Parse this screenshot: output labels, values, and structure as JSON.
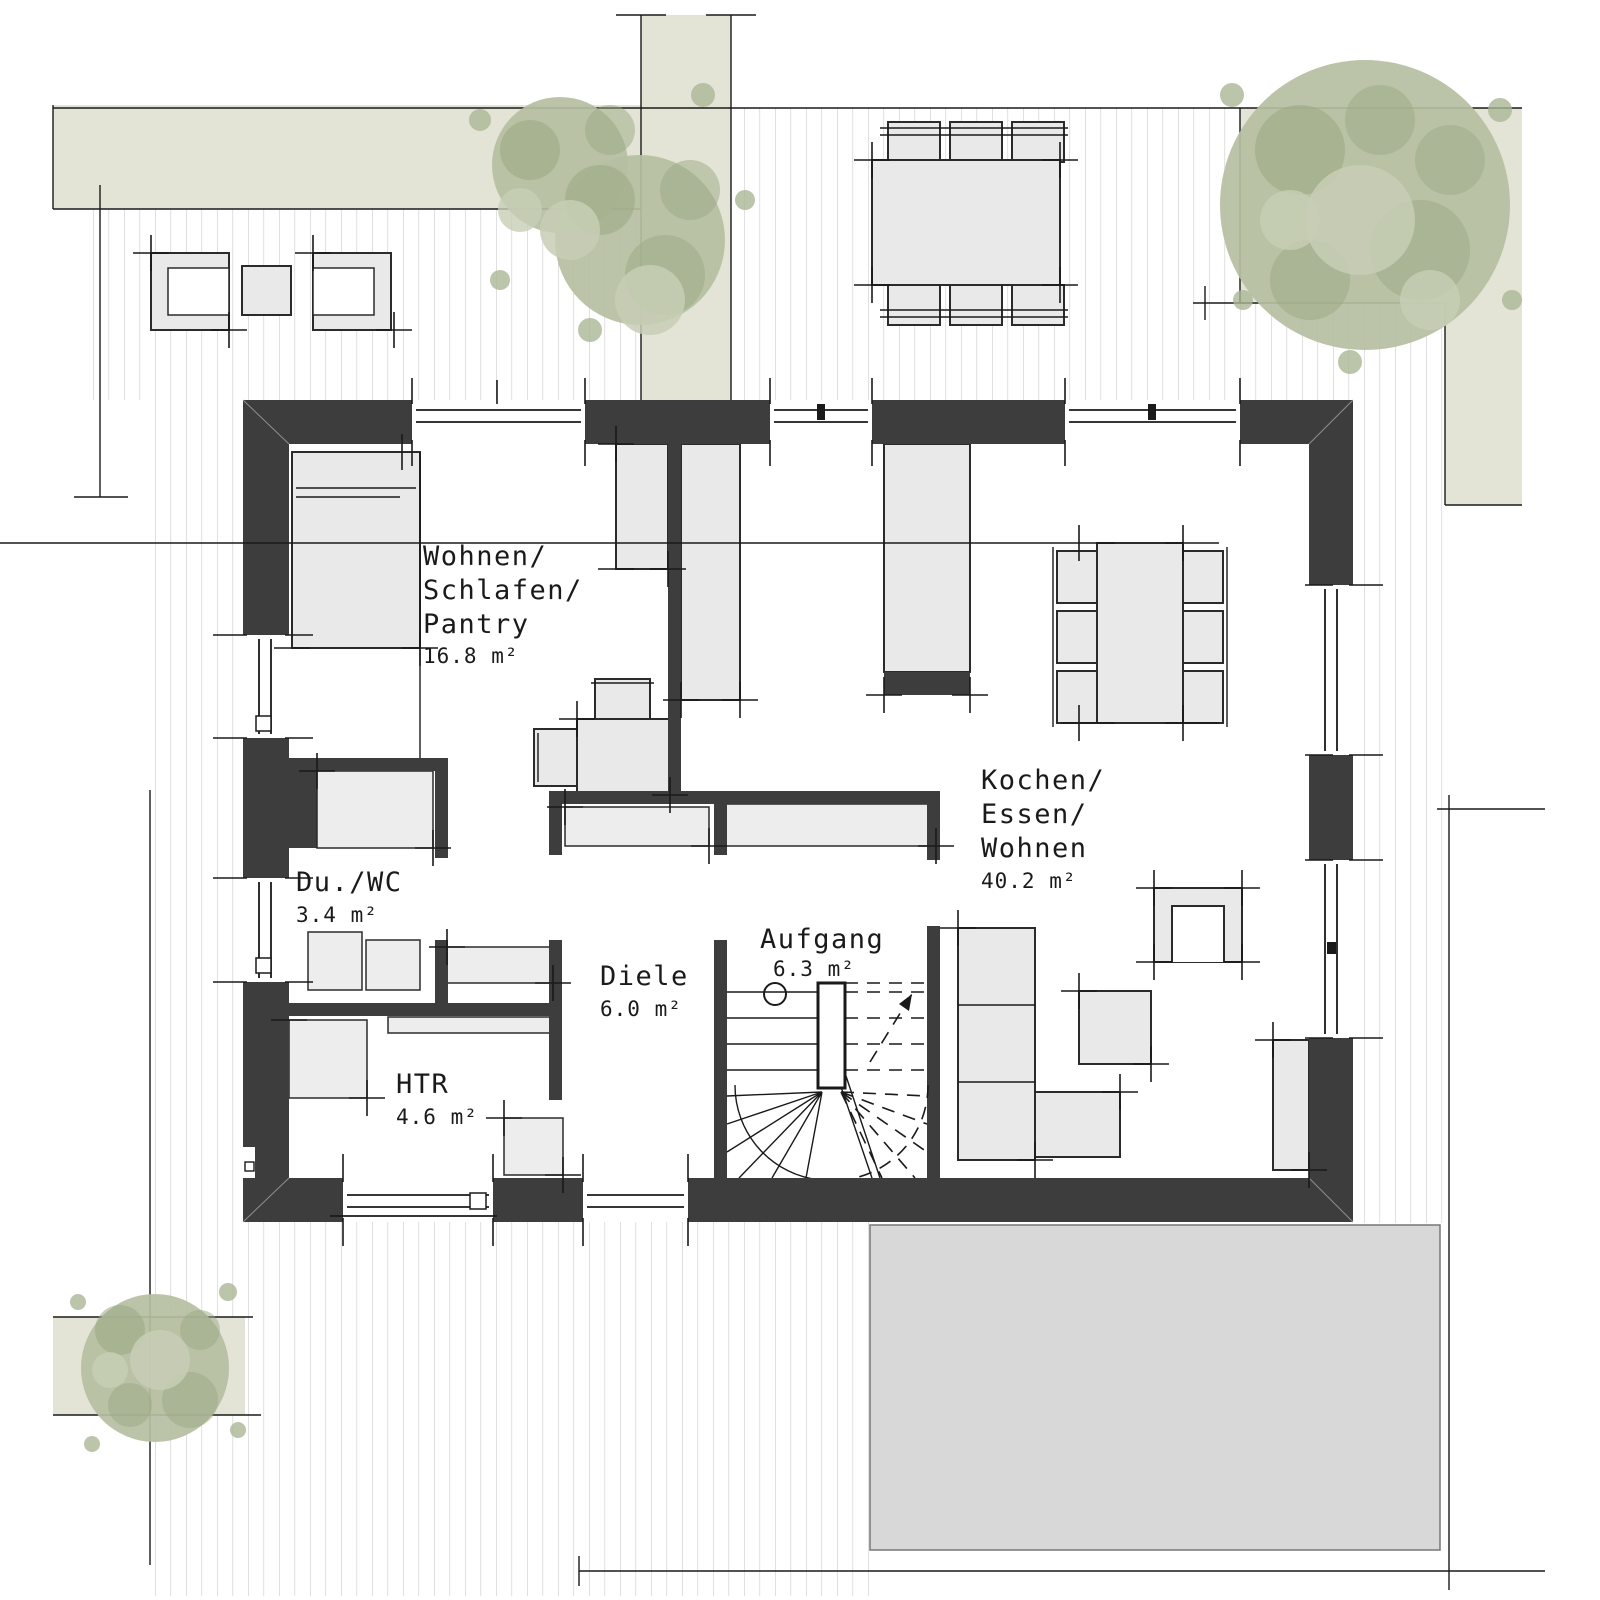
{
  "rooms": {
    "wohnen_schlafen_pantry": {
      "line1": "Wohnen/",
      "line2": "Schlafen/",
      "line3": "Pantry",
      "area": "16.8 m²"
    },
    "du_wc": {
      "name": "Du./WC",
      "area": "3.4 m²"
    },
    "htr": {
      "name": "HTR",
      "area": "4.6 m²"
    },
    "diele": {
      "name": "Diele",
      "area": "6.0 m²"
    },
    "aufgang": {
      "name": "Aufgang",
      "area": "6.3 m²"
    },
    "kochen_essen_wohnen": {
      "line1": "Kochen/",
      "line2": "Essen/",
      "line3": "Wohnen",
      "area": "40.2 m²"
    }
  },
  "colors": {
    "wall": "#3d3d3d",
    "furniture_fill": "#e9e9e9",
    "green_area": "#e3e4d5",
    "tree_base": "#b5bfa1",
    "tree_dark": "#9aa883",
    "slab": "#d8d8d8",
    "deck_stripe": "#cbcbcb",
    "line": "#1a1a1a"
  }
}
